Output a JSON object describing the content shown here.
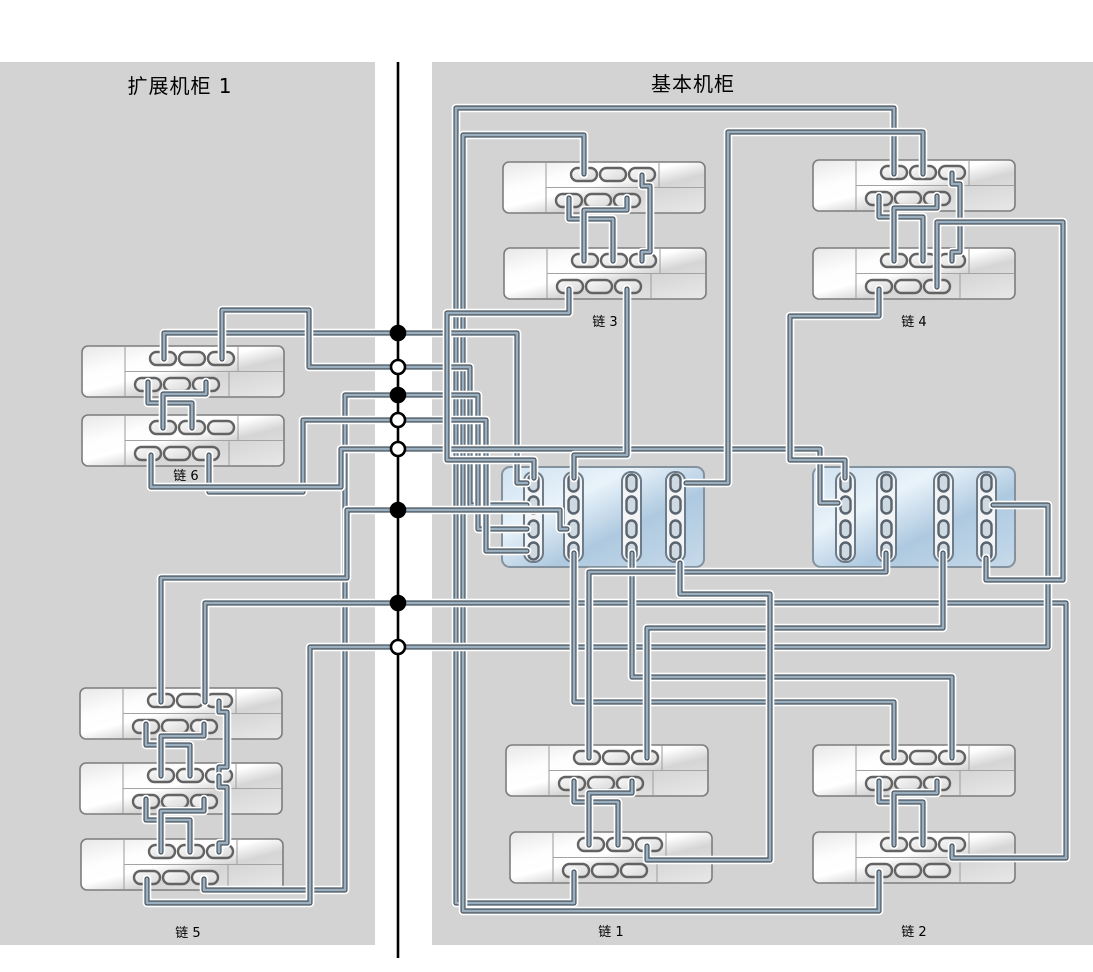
{
  "titles": {
    "left": "扩展机柜 1",
    "right": "基本机柜"
  },
  "chain_labels": [
    {
      "id": "chain-1",
      "label": "链 1",
      "x": 611,
      "y": 936
    },
    {
      "id": "chain-2",
      "label": "链 2",
      "x": 914,
      "y": 936
    },
    {
      "id": "chain-3",
      "label": "链 3",
      "x": 605,
      "y": 326
    },
    {
      "id": "chain-4",
      "label": "链 4",
      "x": 914,
      "y": 326
    },
    {
      "id": "chain-5",
      "label": "链 5",
      "x": 188,
      "y": 937
    },
    {
      "id": "chain-6",
      "label": "链 6",
      "x": 186,
      "y": 480
    }
  ],
  "colors": {
    "panel": "#d3d3d3",
    "divider": "#000000",
    "cable_core": "#9cafbf",
    "cable_dark": "#4e5a66",
    "cable_casing": "#ffffff",
    "shelf_stroke": "#7d7d7d",
    "shelf_line": "#a3a3a3",
    "port_fill": "#ededed",
    "port_stroke": "#636363",
    "controller_stroke": "#84929e",
    "column_fill": "#f2f4f6",
    "column_stroke": "#6e7b88",
    "colport_fill": "#cfd9e1",
    "colport_stroke": "#59646f",
    "dot_filled": "#000000",
    "dot_open": "#ffffff"
  },
  "divider": {
    "x": 398,
    "y1": 62,
    "y2": 958
  },
  "junction_dots": [
    {
      "y": 333,
      "filled": true
    },
    {
      "y": 367,
      "filled": false
    },
    {
      "y": 395,
      "filled": true
    },
    {
      "y": 420,
      "filled": false
    },
    {
      "y": 449,
      "filled": false
    },
    {
      "y": 510,
      "filled": true
    },
    {
      "y": 603,
      "filled": true
    },
    {
      "y": 647,
      "filled": false
    }
  ],
  "shelf_size": {
    "w": 202,
    "h": 51
  },
  "shelves": [
    {
      "id": "exp1-shelf-6a",
      "x": 82,
      "y": 346
    },
    {
      "id": "exp1-shelf-6b",
      "x": 82,
      "y": 415
    },
    {
      "id": "exp1-shelf-5a",
      "x": 80,
      "y": 688
    },
    {
      "id": "exp1-shelf-5b",
      "x": 80,
      "y": 763
    },
    {
      "id": "exp1-shelf-5c",
      "x": 81,
      "y": 839
    },
    {
      "id": "base-shelf-3a",
      "x": 503,
      "y": 162
    },
    {
      "id": "base-shelf-3b",
      "x": 504,
      "y": 248
    },
    {
      "id": "base-shelf-4a",
      "x": 813,
      "y": 160
    },
    {
      "id": "base-shelf-4b",
      "x": 813,
      "y": 248
    },
    {
      "id": "base-shelf-1a",
      "x": 506,
      "y": 745
    },
    {
      "id": "base-shelf-1b",
      "x": 510,
      "y": 832
    },
    {
      "id": "base-shelf-2a",
      "x": 813,
      "y": 745
    },
    {
      "id": "base-shelf-2b",
      "x": 813,
      "y": 832
    }
  ],
  "controller_size": {
    "w": 202,
    "h": 100
  },
  "controllers": [
    {
      "id": "controller-left",
      "x": 502,
      "y": 467,
      "cols": [
        524,
        564,
        622,
        666
      ]
    },
    {
      "id": "controller-right",
      "x": 813,
      "y": 467,
      "cols": [
        836,
        877,
        934,
        977
      ]
    }
  ],
  "controller_port_rows": [
    483,
    505,
    529,
    551
  ],
  "shelf_groups": [
    {
      "sx": 503,
      "ty": 162,
      "by": 248,
      "c": true
    },
    {
      "sx": 813,
      "ty": 160,
      "by": 248,
      "c": true
    },
    {
      "sx": 508,
      "ty": 745,
      "by": 832,
      "c": false
    },
    {
      "sx": 813,
      "ty": 745,
      "by": 832,
      "c": false
    },
    {
      "sx": 82,
      "ty": 346,
      "by": 415,
      "c": false
    },
    {
      "sx": 80,
      "ty": 688,
      "by": 763,
      "c": true
    },
    {
      "sx": 80,
      "ty": 763,
      "by": 839,
      "c": true
    }
  ],
  "cables": [
    [
      [
        894,
        174
      ],
      [
        894,
        108
      ],
      [
        456,
        108
      ],
      [
        456,
        903
      ],
      [
        574,
        903
      ],
      [
        574,
        872
      ]
    ],
    [
      [
        584,
        174
      ],
      [
        584,
        135
      ],
      [
        463,
        135
      ],
      [
        463,
        911
      ],
      [
        879,
        911
      ],
      [
        879,
        872
      ]
    ],
    [
      [
        164,
        359
      ],
      [
        164,
        333
      ],
      [
        517,
        333
      ],
      [
        517,
        483
      ],
      [
        527,
        483
      ]
    ],
    [
      [
        222,
        359
      ],
      [
        222,
        310
      ],
      [
        309,
        310
      ],
      [
        309,
        367
      ],
      [
        470,
        367
      ],
      [
        470,
        505
      ],
      [
        527,
        505
      ]
    ],
    [
      [
        204,
        879
      ],
      [
        204,
        890
      ],
      [
        345,
        890
      ],
      [
        345,
        395
      ],
      [
        478,
        395
      ],
      [
        478,
        529
      ],
      [
        527,
        529
      ]
    ],
    [
      [
        209,
        455
      ],
      [
        209,
        492
      ],
      [
        303,
        492
      ],
      [
        303,
        420
      ],
      [
        486,
        420
      ],
      [
        486,
        551
      ],
      [
        527,
        551
      ]
    ],
    [
      [
        151,
        455
      ],
      [
        151,
        487
      ],
      [
        341,
        487
      ],
      [
        341,
        449
      ],
      [
        820,
        449
      ],
      [
        820,
        503
      ],
      [
        838,
        503
      ]
    ],
    [
      [
        161,
        702
      ],
      [
        161,
        578
      ],
      [
        347,
        578
      ],
      [
        347,
        510
      ],
      [
        560,
        510
      ],
      [
        560,
        529
      ],
      [
        567,
        529
      ]
    ],
    [
      [
        205,
        702
      ],
      [
        205,
        603
      ],
      [
        1066,
        603
      ],
      [
        1066,
        858
      ],
      [
        952,
        858
      ],
      [
        952,
        846
      ]
    ],
    [
      [
        147,
        879
      ],
      [
        147,
        903
      ],
      [
        310,
        903
      ],
      [
        310,
        647
      ],
      [
        1048,
        647
      ],
      [
        1048,
        505
      ],
      [
        993,
        505
      ]
    ],
    [
      [
        574,
        553
      ],
      [
        574,
        702
      ],
      [
        894,
        702
      ],
      [
        894,
        758
      ]
    ],
    [
      [
        632,
        553
      ],
      [
        632,
        677
      ],
      [
        952,
        677
      ],
      [
        952,
        758
      ]
    ],
    [
      [
        943,
        553
      ],
      [
        943,
        628
      ],
      [
        647,
        628
      ],
      [
        647,
        758
      ]
    ],
    [
      [
        886,
        553
      ],
      [
        886,
        572
      ],
      [
        589,
        572
      ],
      [
        589,
        758
      ]
    ],
    [
      [
        627,
        289
      ],
      [
        627,
        455
      ],
      [
        574,
        455
      ],
      [
        574,
        478
      ]
    ],
    [
      [
        569,
        289
      ],
      [
        569,
        313
      ],
      [
        447,
        313
      ],
      [
        447,
        460
      ],
      [
        534,
        460
      ],
      [
        534,
        478
      ]
    ],
    [
      [
        879,
        289
      ],
      [
        879,
        316
      ],
      [
        790,
        316
      ],
      [
        790,
        460
      ],
      [
        845,
        460
      ],
      [
        845,
        478
      ]
    ],
    [
      [
        986,
        558
      ],
      [
        986,
        580
      ],
      [
        1063,
        580
      ],
      [
        1063,
        222
      ],
      [
        937,
        222
      ],
      [
        937,
        287
      ]
    ],
    [
      [
        923,
        174
      ],
      [
        923,
        132
      ],
      [
        728,
        132
      ],
      [
        728,
        483
      ],
      [
        686,
        483
      ]
    ],
    [
      [
        647,
        846
      ],
      [
        647,
        860
      ],
      [
        770,
        860
      ],
      [
        770,
        594
      ],
      [
        680,
        594
      ],
      [
        680,
        563
      ]
    ]
  ]
}
